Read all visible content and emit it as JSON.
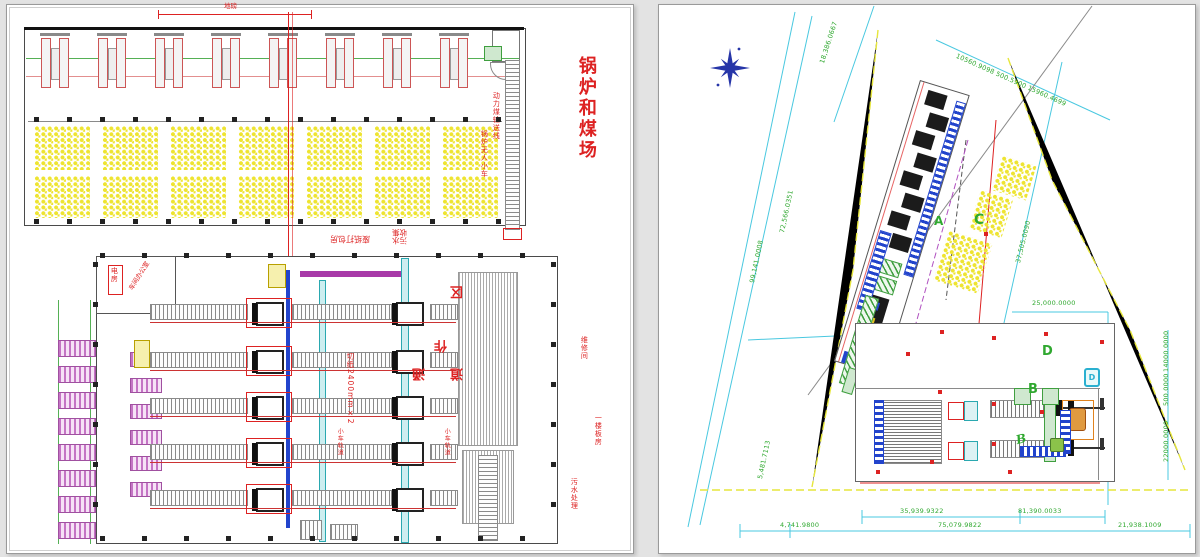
{
  "colors": {
    "annotation_red": "#dd2222",
    "dim_green": "#2fa82f",
    "dim_cyan": "#49c8e0",
    "pile_yellow": "#eee431",
    "equip_magenta": "#c060c0",
    "strip_teal": "#2aa8b0",
    "deep_blue": "#2244cc",
    "compass_blue": "#2635a8",
    "equip_orange": "#e0831f",
    "boundary_yellow": "#e6e63c"
  },
  "left_panel": {
    "boiler_coal_label": "锅炉和煤场",
    "weighbridge_label": "地磅",
    "conveyor_label_top": "动力煤输送线",
    "conveyor_label_bottom": "锅炉无人小车",
    "packing_room_label": "废纸打包房",
    "sewage_label": "污水收集",
    "cutter_label": "切纸2400mm×2",
    "zone_chars": [
      "区",
      "作",
      "通",
      "道"
    ],
    "power_room_label": "电房",
    "office_label": "车间办公室",
    "track_label_left": "小车轨道",
    "track_label_right": "小车轨道",
    "side_label_1": "维修间",
    "side_label_2": "一楼板房",
    "side_label_3": "污水处理"
  },
  "right_panel": {
    "zone_a": "A",
    "zone_b": "B",
    "zone_b2": "B",
    "zone_c": "C",
    "zone_d": "D",
    "tank_d": "D",
    "dims": {
      "top_edge": "10560.9098   500.5900   15960.4699",
      "north_slant": "18,386.0667",
      "left_inner": "72,566.0351",
      "left_outer": "99,141.0008",
      "left_bottom": "5,481.7113",
      "c_slant": "37,505.0090",
      "d_width": "25,000.0000",
      "right_1": "14000.0000",
      "right_2": "500.0000",
      "right_3": "22000.0000",
      "bottom_upper_1": "35,939.9322",
      "bottom_upper_2": "81,390.0033",
      "bottom_lower_1": "4,741.9800",
      "bottom_lower_2": "75,079.9822",
      "bottom_lower_3": "21,938.1009"
    }
  }
}
